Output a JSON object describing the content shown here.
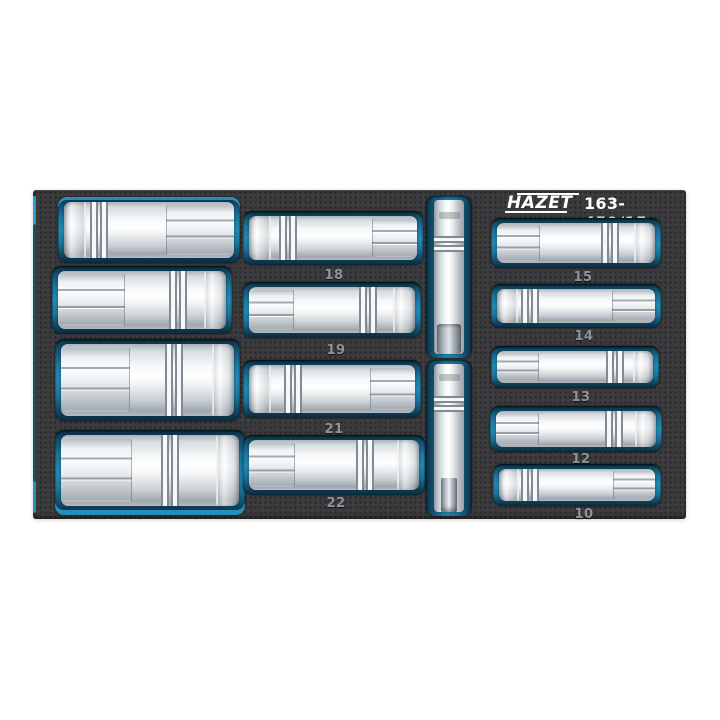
{
  "header": {
    "brand": "HAZET",
    "part_number": "163-459/15"
  },
  "tray": {
    "left_column": {
      "socket_count": 4
    },
    "middle_column": {
      "labels": [
        "18",
        "19",
        "21",
        "22"
      ]
    },
    "right_column": {
      "labels": [
        "15",
        "14",
        "13",
        "12",
        "10"
      ]
    },
    "center_column": {
      "extension_count": 2
    }
  },
  "colors": {
    "background": "#ffffff",
    "foam": "#3b3b3d",
    "pocket_blue": "#2190bd",
    "pocket_blue_dark": "#0c2e41",
    "accent_cyan": "#2ba6d8",
    "chrome_light": "#ffffff",
    "chrome_dark": "#9fa7ae",
    "label_text": "#8d9398",
    "header_text": "#ffffff"
  }
}
